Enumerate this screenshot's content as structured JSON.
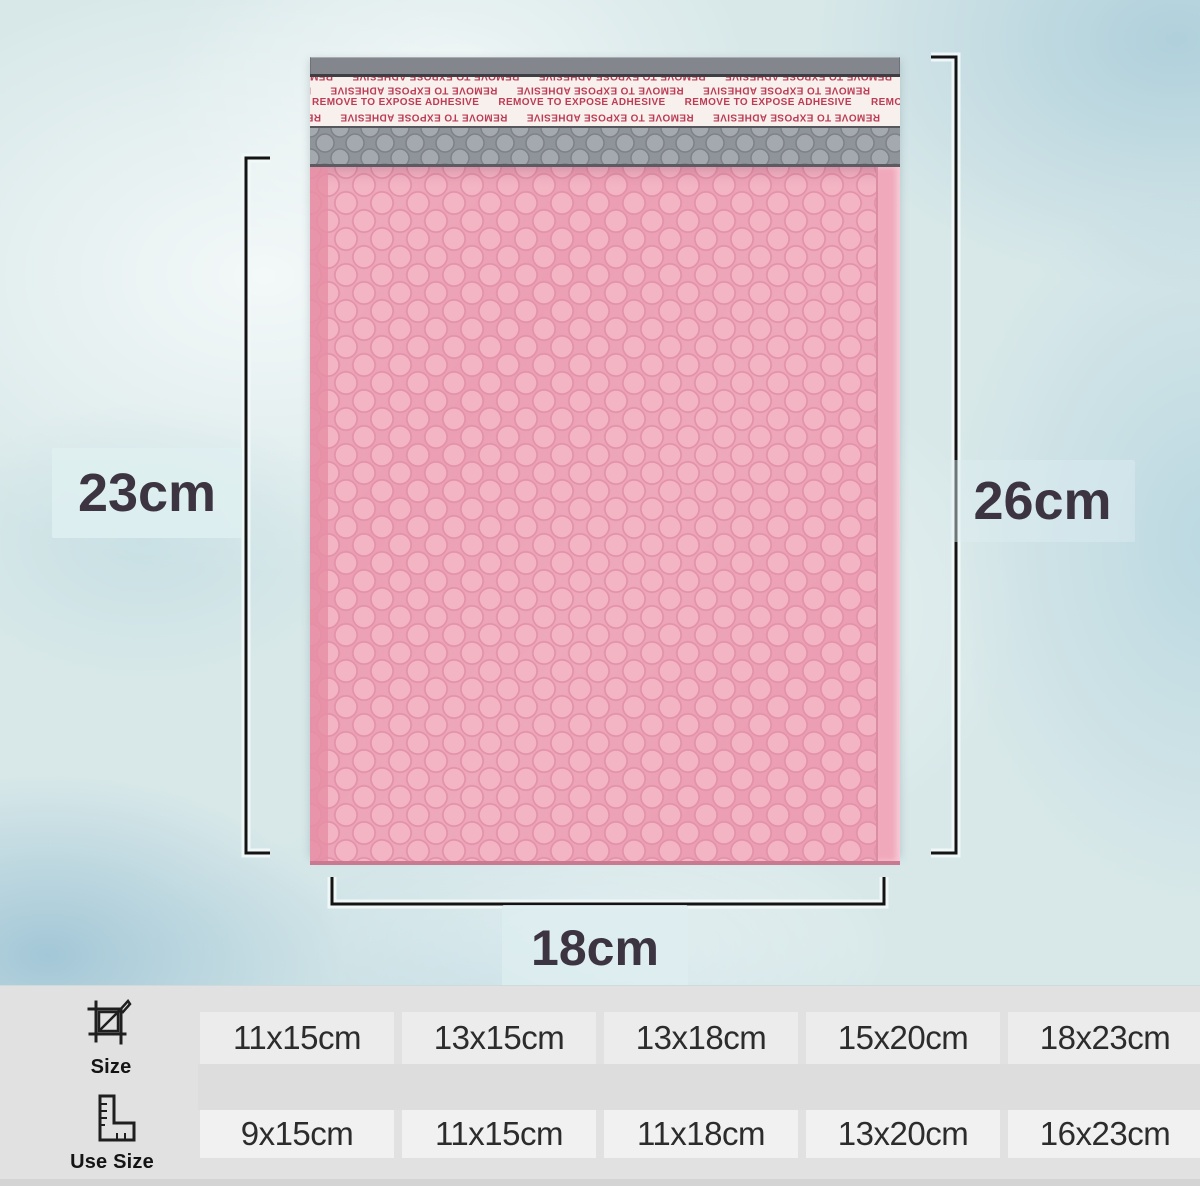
{
  "product": {
    "name": "pink bubble mailer",
    "colors": {
      "body_pink": "#ec9fb4",
      "bubble_highlight": "#f3b4c4",
      "liner_gray": "#8f939a",
      "strip_red": "#bd3c55",
      "background_blue": "#d8e8e9",
      "table_gray": "#e0e1e0"
    }
  },
  "mailer": {
    "strip_text": "REMOVE TO EXPOSE ADHESIVE",
    "strip_row_repeated": "REMOVE TO EXPOSE ADHESIVE      REMOVE TO EXPOSE ADHESIVE      REMOVE TO EXPOSE ADHESIVE      REMOVE TO EXPOSE ADHESIVE"
  },
  "dimensions": {
    "left": "23cm",
    "right": "26cm",
    "bottom": "18cm"
  },
  "size_table": {
    "rows": [
      {
        "label": "Size",
        "icon": "crop-size-icon",
        "values": [
          "11x15cm",
          "13x15cm",
          "13x18cm",
          "15x20cm",
          "18x23cm"
        ]
      },
      {
        "label": "Use Size",
        "icon": "ruler-square-icon",
        "values": [
          "9x15cm",
          "11x15cm",
          "11x18cm",
          "13x20cm",
          "16x23cm"
        ]
      }
    ]
  }
}
